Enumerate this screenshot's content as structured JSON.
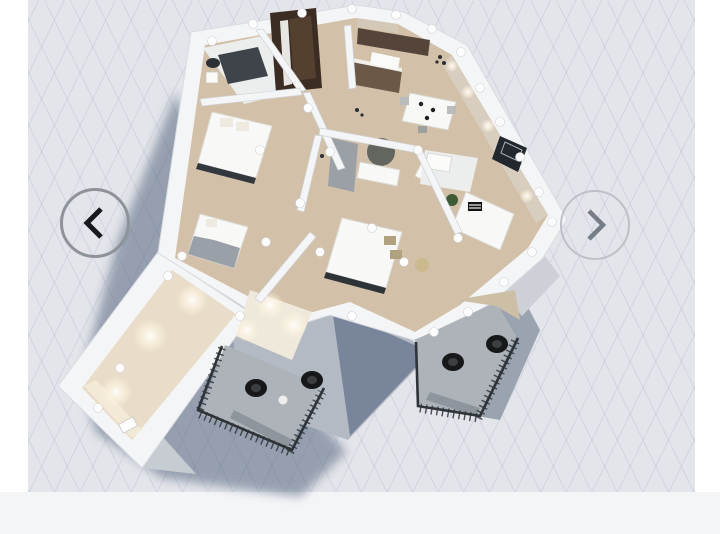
{
  "viewer": {
    "type": "3d-floorplan-carousel",
    "nav": {
      "prev": {
        "label": "Previous floorplan",
        "glyph": "‹"
      },
      "next": {
        "label": "Next floorplan",
        "glyph": "›"
      }
    },
    "canvas": {
      "width": 720,
      "height": 534,
      "grid": "isometric-diamond"
    }
  },
  "scene": {
    "description": "isometric 3d apartment floorplan render with cast shadow",
    "elements": [
      "entry-door",
      "bathroom-vanity",
      "washer",
      "kitchen-upper-cabinets",
      "kitchen-lower-cabinets",
      "dining-table",
      "dining-chairs",
      "armchair",
      "sofa",
      "striped-cushion",
      "window-frames",
      "houseplant",
      "bed-small",
      "bed-guest",
      "bed-master",
      "pillows",
      "round-mirror-table",
      "interior-door",
      "vanity-dresser",
      "stool",
      "ceiling-downlights",
      "ceiling-fixtures",
      "balcony-center",
      "balcony-right",
      "balcony-railings",
      "egg-chairs",
      "side-tables",
      "long-hall-room"
    ]
  },
  "palette": {
    "page-bg": "#ffffff",
    "canvas-bg": "#e3e5ea",
    "strip-bg": "#f4f5f7",
    "shadow": "#4f607a",
    "wall-white": "#f4f5f6",
    "wall-edge": "#d3d6db",
    "facade-light": "#c7cbd2",
    "facade-dark": "#78859a",
    "floor-wood": "#d2c0a8",
    "floor-tile": "#eceeee",
    "wall-beige": "#d8cec0",
    "glow-warm": "#f6ecd8",
    "door-brown": "#3b2d24",
    "door-leaf": "#54402f",
    "railing": "#2e3338",
    "furniture-white": "#f8f8f6",
    "furniture-dark": "#3f444a",
    "cushion-olive": "#b0a27e",
    "plant-green": "#3e5a34",
    "window-dark": "#23282e",
    "balcony-floor": "#aeb3ba",
    "chair-black": "#17181a",
    "ring-left": "#8e939a",
    "ring-right": "#bcc1c8",
    "chevron-left": "#17191d",
    "chevron-right": "#767d87"
  }
}
